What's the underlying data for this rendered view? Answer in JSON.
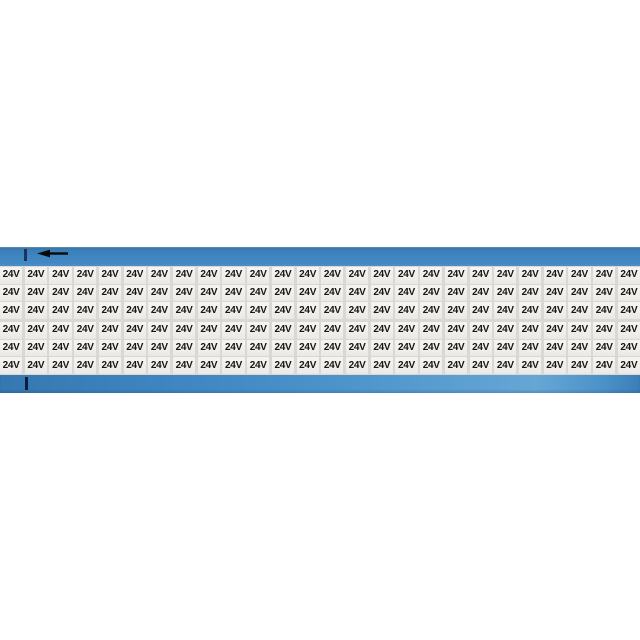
{
  "product": {
    "marker_label": "24V",
    "grid": {
      "rows": 6,
      "columns": 26,
      "rows_per_group": 3
    },
    "arrow_direction": "left"
  },
  "colors": {
    "band_blue": "#3f86c3",
    "band_blue_light": "#5c9fd1",
    "band_blue_dark": "#39749f",
    "carrier_gray": "#d9d8d4",
    "cell_bg": "#f1f0ec",
    "text": "#161616",
    "tick_navy": "#0e1c3f",
    "arrow_black": "#0a0a0a",
    "page_bg": "#ffffff"
  }
}
